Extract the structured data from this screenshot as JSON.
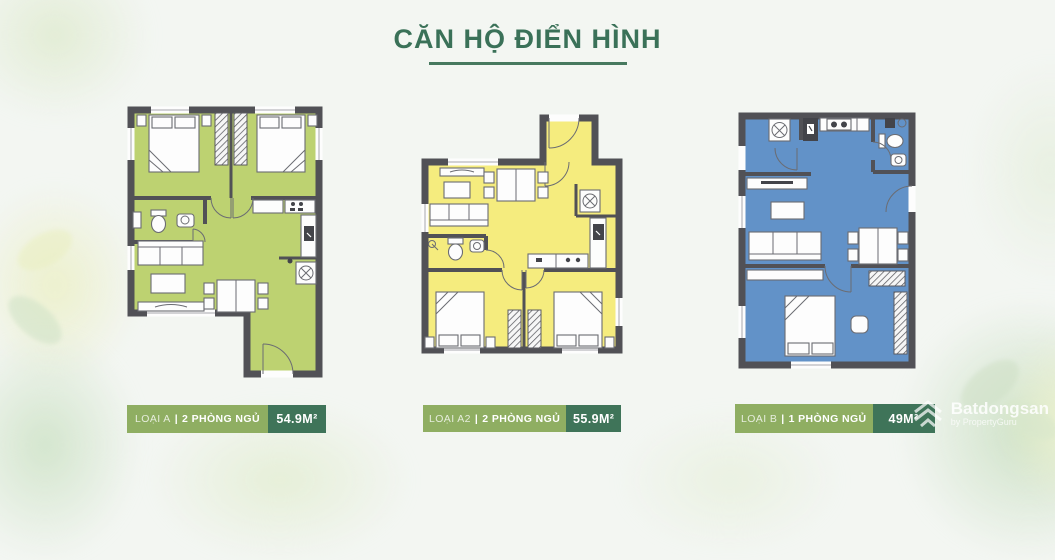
{
  "header": {
    "title": "CĂN HỘ ĐIỂN HÌNH",
    "title_color": "#3a7158",
    "underline_color": "#47795f"
  },
  "floor_plans": [
    {
      "id": "loai-a",
      "type_label": "LOẠI A",
      "separator": "|",
      "rooms_label": "2 PHÒNG NGỦ",
      "area_label": "54.9M²",
      "bedrooms": 2,
      "floor_color": "#bdd271"
    },
    {
      "id": "loai-a2",
      "type_label": "LOẠI A2",
      "separator": "|",
      "rooms_label": "2 PHÒNG NGỦ",
      "area_label": "55.9M²",
      "bedrooms": 2,
      "floor_color": "#f5ec7e"
    },
    {
      "id": "loai-b",
      "type_label": "LOẠI B",
      "separator": "|",
      "rooms_label": "1 PHÒNG NGỦ",
      "area_label": "49M²",
      "bedrooms": 1,
      "floor_color": "#6292c8"
    }
  ],
  "label_style": {
    "type_bg": "#8fae62",
    "area_bg": "#3f7459",
    "text_color": "#ffffff",
    "wall_color": "#515156"
  },
  "watermark": {
    "brand": "Batdongsan",
    "byline": "by PropertyGuru"
  }
}
